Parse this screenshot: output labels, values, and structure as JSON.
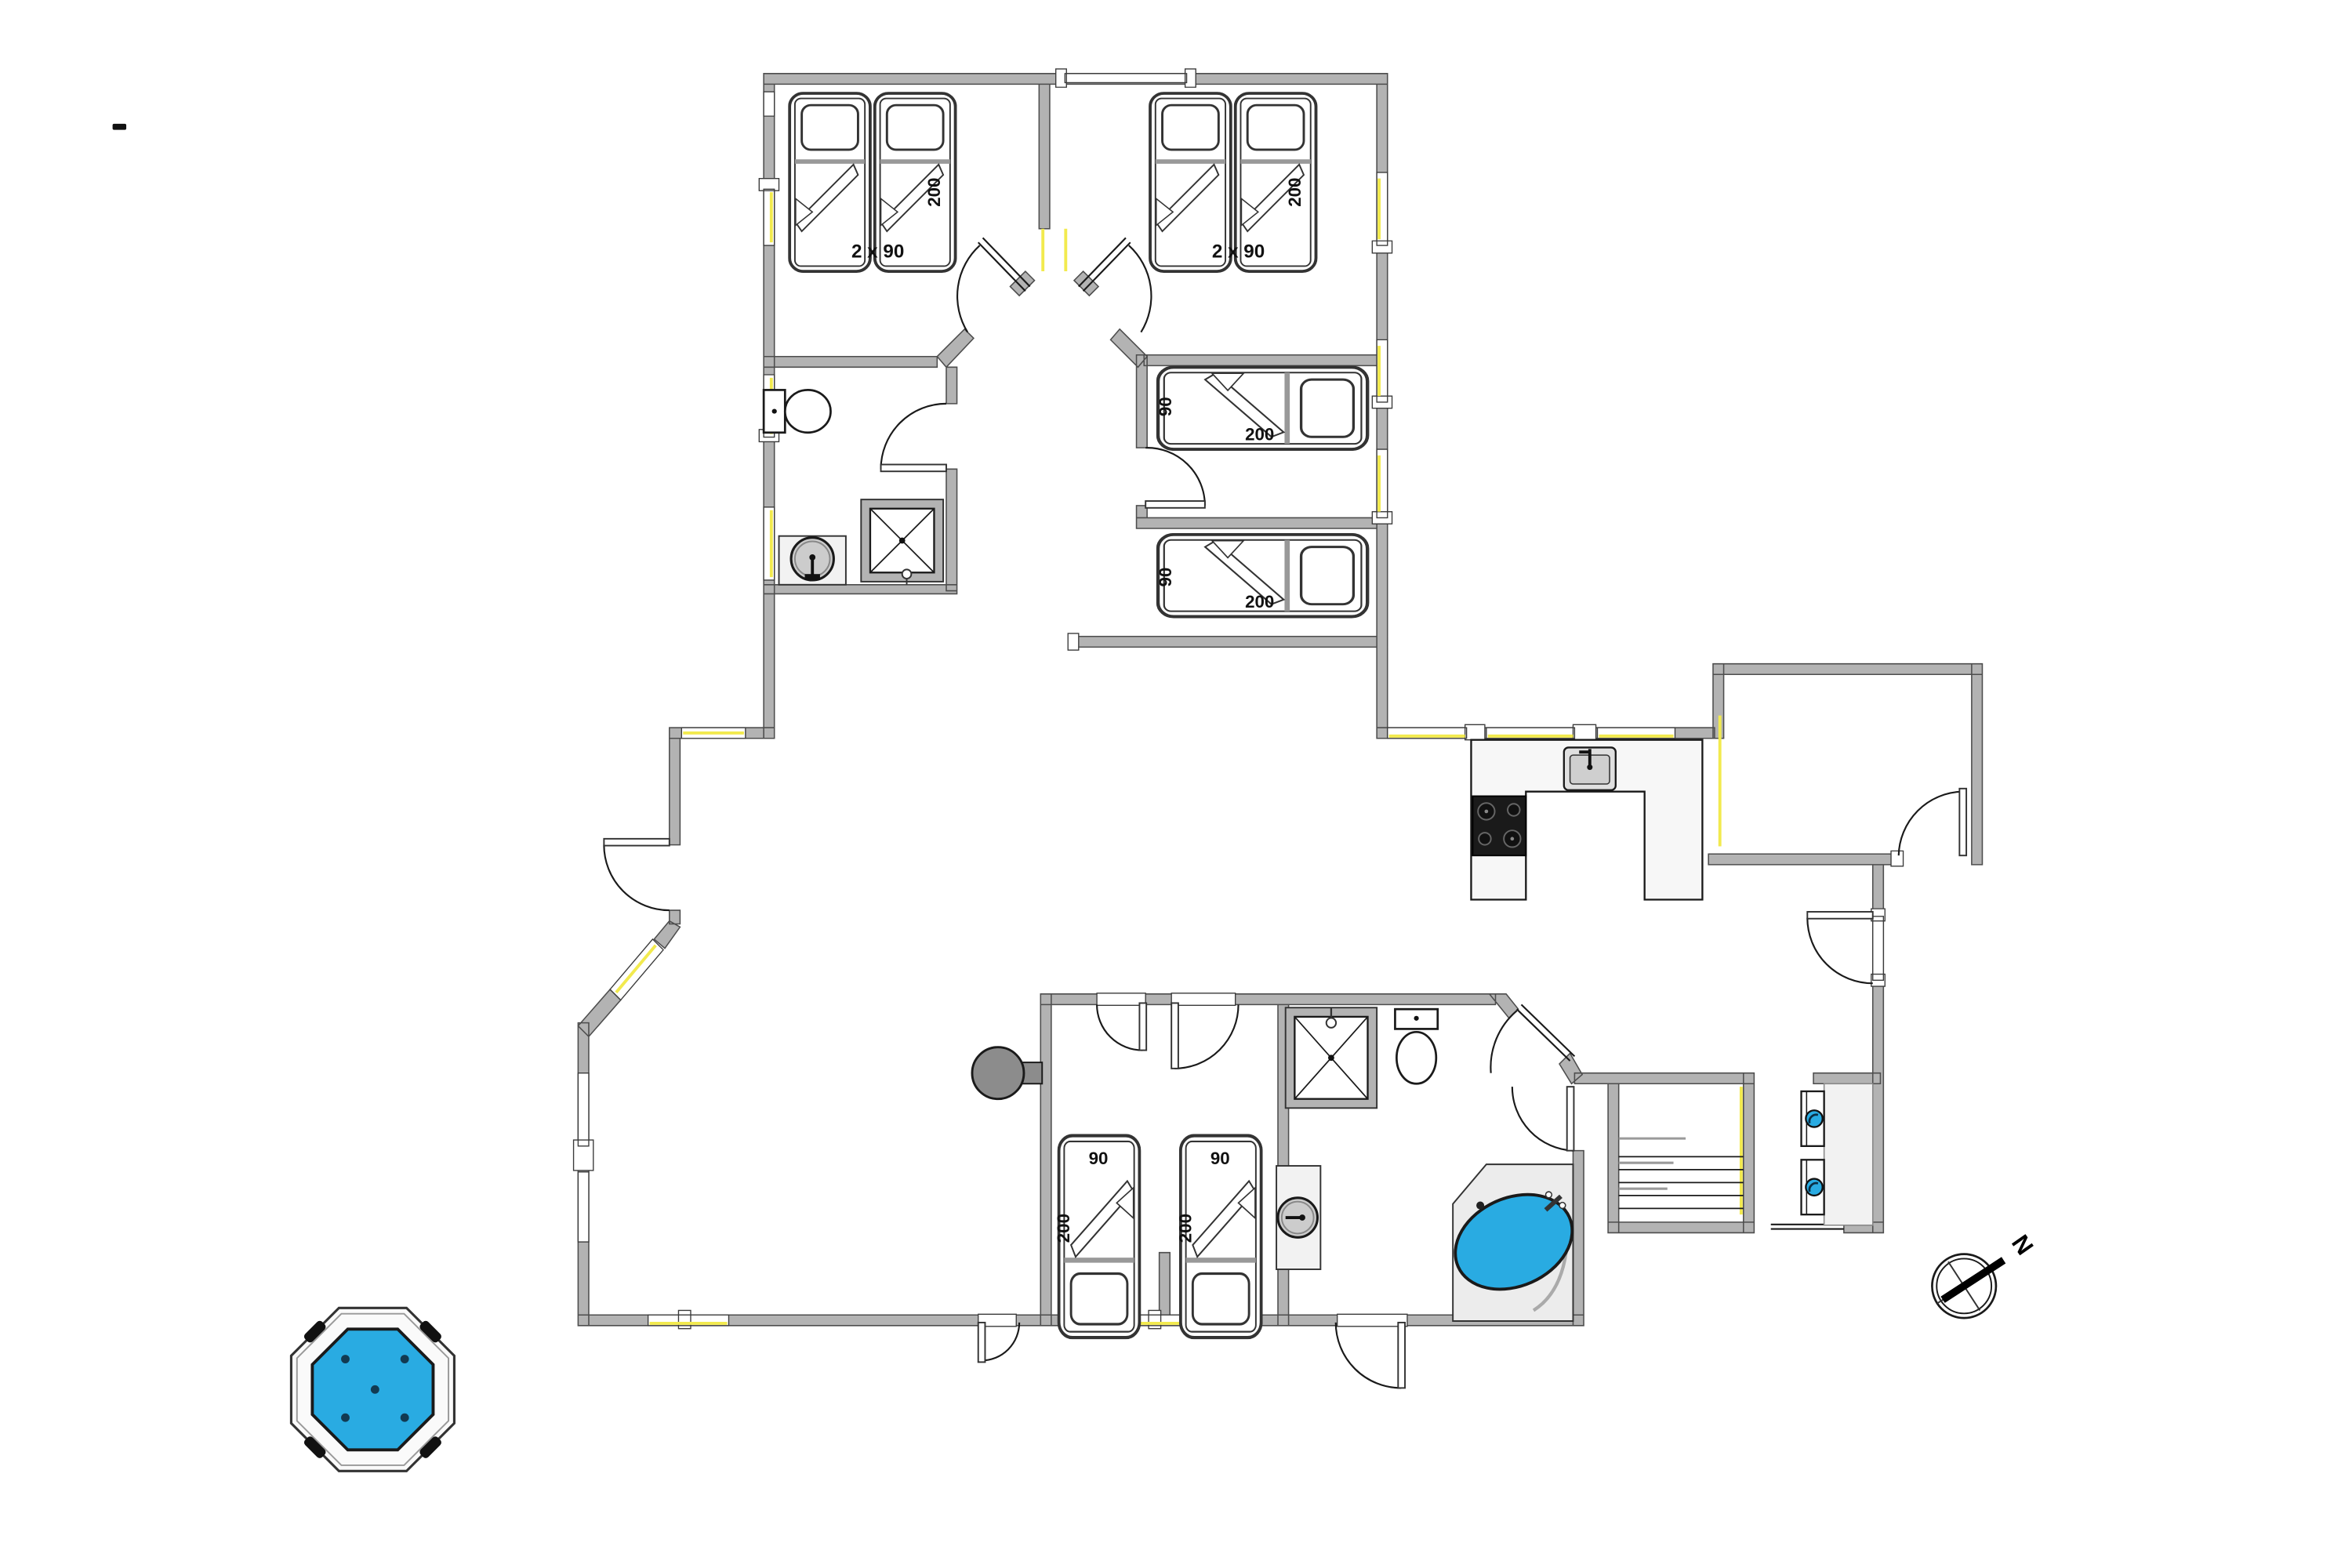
{
  "floorplan": {
    "compass": {
      "north_label": "N"
    },
    "bedrooms": {
      "top_left": {
        "beds_label": "2 x 90",
        "length_label": "200"
      },
      "top_right": {
        "beds_label": "2 x 90",
        "length_label": "200"
      },
      "mid_room_upper": {
        "width_label": "90",
        "length_label": "200"
      },
      "mid_room_lower": {
        "width_label": "90",
        "length_label": "200"
      },
      "bottom_left": {
        "width_label": "90",
        "length_label": "200"
      },
      "bottom_right": {
        "width_label": "90",
        "length_label": "200"
      }
    },
    "fixtures": [
      "toilet-icon",
      "shower-icon",
      "sink-icon",
      "bathtub-icon",
      "hot-tub-icon",
      "wood-stove-icon",
      "kitchen-sink-icon",
      "cooktop-icon",
      "stairs-icon",
      "washer-icon",
      "compass-icon"
    ],
    "colors": {
      "wall": "#b3b3b3",
      "wall_outline": "#4d4d4d",
      "water": "#29abe2",
      "window_accent": "#f2ea4e",
      "fixture_gray": "#cccccc",
      "floor": "#ffffff"
    }
  }
}
